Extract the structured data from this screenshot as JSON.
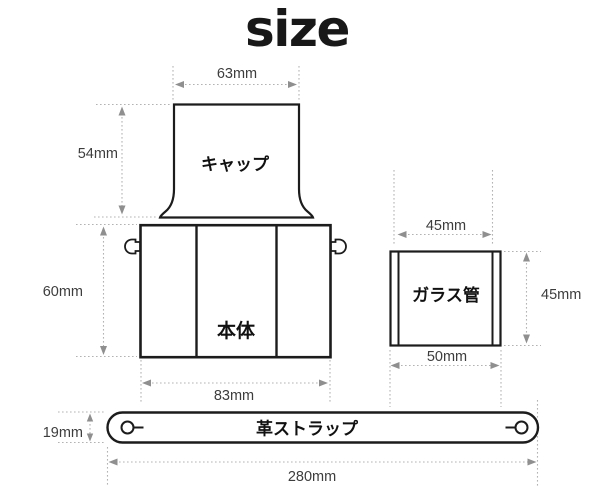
{
  "title": "size",
  "parts": {
    "cap": {
      "label": "キャップ",
      "dims": {
        "width": "63mm",
        "height": "54mm"
      }
    },
    "body": {
      "label": "本体",
      "dims": {
        "height": "60mm",
        "width": "83mm"
      }
    },
    "glass": {
      "label": "ガラス管",
      "dims": {
        "top_width": "45mm",
        "height": "45mm",
        "bottom_width": "50mm"
      }
    },
    "strap": {
      "label": "革ストラップ",
      "dims": {
        "height": "19mm",
        "length": "280mm"
      }
    }
  },
  "colors": {
    "background": "#ffffff",
    "outline_ink": "#1c1c1c",
    "dimension_line": "#b3b3b3",
    "arrowhead": "#8f8f8f",
    "dimension_text": "#3d3d3d",
    "inner_detail": "#dcdcdc"
  }
}
